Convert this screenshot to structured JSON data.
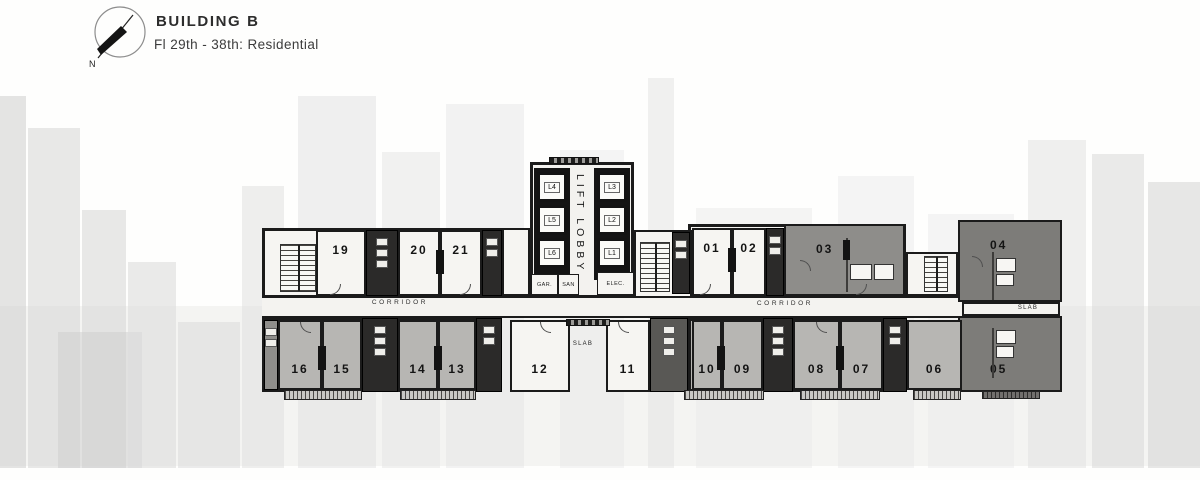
{
  "header": {
    "title": "BUILDING B",
    "subtitle": "Fl 29th - 38th: Residential",
    "compass_label": "N"
  },
  "plan": {
    "colors": {
      "wall": "#1b1b1b",
      "unit-light": "#f6f5f2",
      "unit-mid": "#b7b6b3",
      "unit-dark": "#7d7c79",
      "unit-dark-2": "#8e8d8a",
      "corridor": "#f4f3f0"
    },
    "lift_lobby_label": "LIFT LOBBY",
    "lifts": [
      {
        "label": "L4"
      },
      {
        "label": "L5"
      },
      {
        "label": "L6"
      },
      {
        "label": "L3"
      },
      {
        "label": "L2"
      },
      {
        "label": "L1"
      }
    ],
    "rooms": [
      {
        "label": "GAR."
      },
      {
        "label": "SAN"
      },
      {
        "label": "ELEC."
      }
    ],
    "corridors": [
      {
        "label": "CORRIDOR"
      },
      {
        "label": "CORRIDOR"
      }
    ],
    "slabs": [
      {
        "label": "SLAB"
      },
      {
        "label": "SLAB"
      }
    ],
    "units": [
      {
        "label": "19"
      },
      {
        "label": "20"
      },
      {
        "label": "21"
      },
      {
        "label": "01"
      },
      {
        "label": "02"
      },
      {
        "label": "03"
      },
      {
        "label": "04"
      },
      {
        "label": "05"
      },
      {
        "label": "06"
      },
      {
        "label": "07"
      },
      {
        "label": "08"
      },
      {
        "label": "09"
      },
      {
        "label": "10"
      },
      {
        "label": "11"
      },
      {
        "label": "12"
      },
      {
        "label": "13"
      },
      {
        "label": "14"
      },
      {
        "label": "15"
      },
      {
        "label": "16"
      }
    ]
  }
}
